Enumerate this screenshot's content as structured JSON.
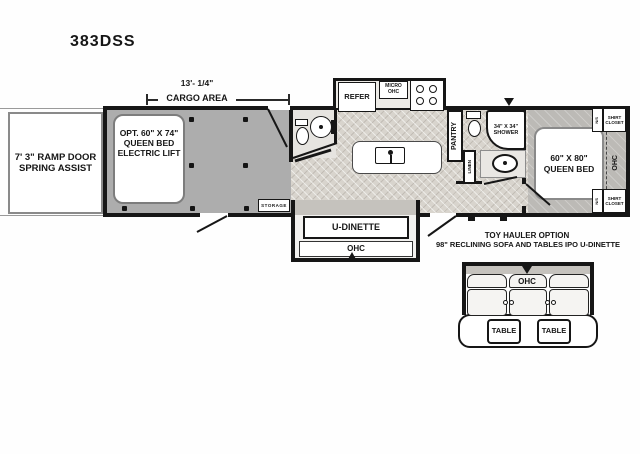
{
  "title": "383DSS",
  "dimension": {
    "length": "13'- 1/4\"",
    "area": "CARGO AREA"
  },
  "ramp": {
    "line1": "7' 3\" RAMP DOOR",
    "line2": "SPRING ASSIST"
  },
  "cargo": {
    "bed_line1": "OPT. 60\" X 74\"",
    "bed_line2": "QUEEN BED",
    "bed_line3": "ELECTRIC LIFT",
    "storage": "STORAGE"
  },
  "kitchen": {
    "refer": "REFER",
    "micro_line1": "MICRO",
    "micro_line2": "OHC",
    "pantry": "PANTRY"
  },
  "bath": {
    "shower_line1": "34\" X 34\"",
    "shower_line2": "SHOWER",
    "linen": "LINEN"
  },
  "bedroom": {
    "bed_line1": "60\" X 80\"",
    "bed_line2": "QUEEN BED",
    "ohc": "OHC",
    "ns_top": "N/S",
    "ns_bottom": "N/S",
    "shirt_top_line1": "SHIRT",
    "shirt_top_line2": "CLOSET",
    "shirt_bottom_line1": "SHIRT",
    "shirt_bottom_line2": "CLOSET"
  },
  "dinette": {
    "label": "U-DINETTE",
    "ohc": "OHC"
  },
  "sofa_option": {
    "note_line1": "TOY HAULER OPTION",
    "note_line2": "98\" RECLINING SOFA AND TABLES IPO U-DINETTE",
    "ohc": "OHC",
    "table1": "TABLE",
    "table2": "TABLE"
  },
  "colors": {
    "wall": "#161616",
    "cargo_floor": "#adadad",
    "living_floor": "#d8d4cd",
    "bedroom_floor": "#bcbab6"
  }
}
